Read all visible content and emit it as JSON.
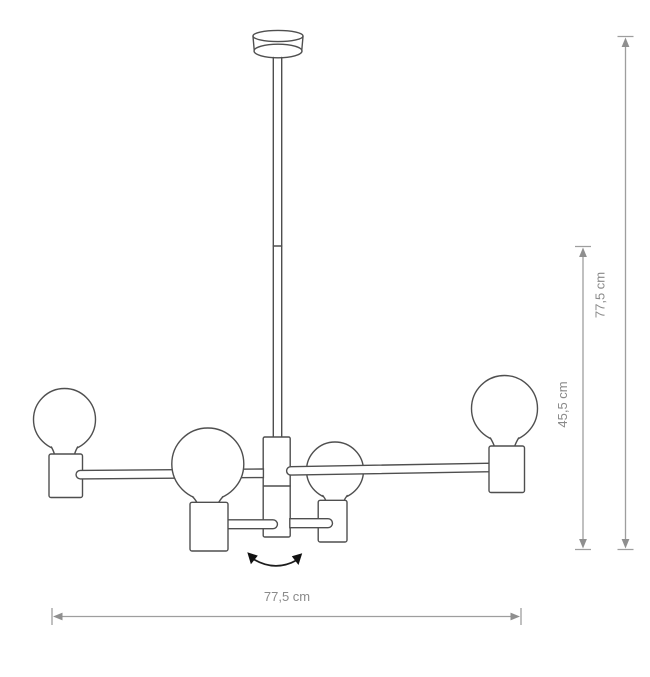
{
  "page": {
    "background": "#ffffff"
  },
  "colors": {
    "outline": "#4f4f4f",
    "dimension_line": "#9e9e9e",
    "dimension_arrow": "#8f8f8f",
    "label_text": "#8a8a8a",
    "rotation_arrow": "#1c1c1c"
  },
  "icons": {
    "rotation_arrow": "curved-double-headed-arrow"
  },
  "labels": {
    "total_height": "77,5 cm",
    "body_height": "45,5 cm",
    "total_width": "77,5 cm"
  }
}
